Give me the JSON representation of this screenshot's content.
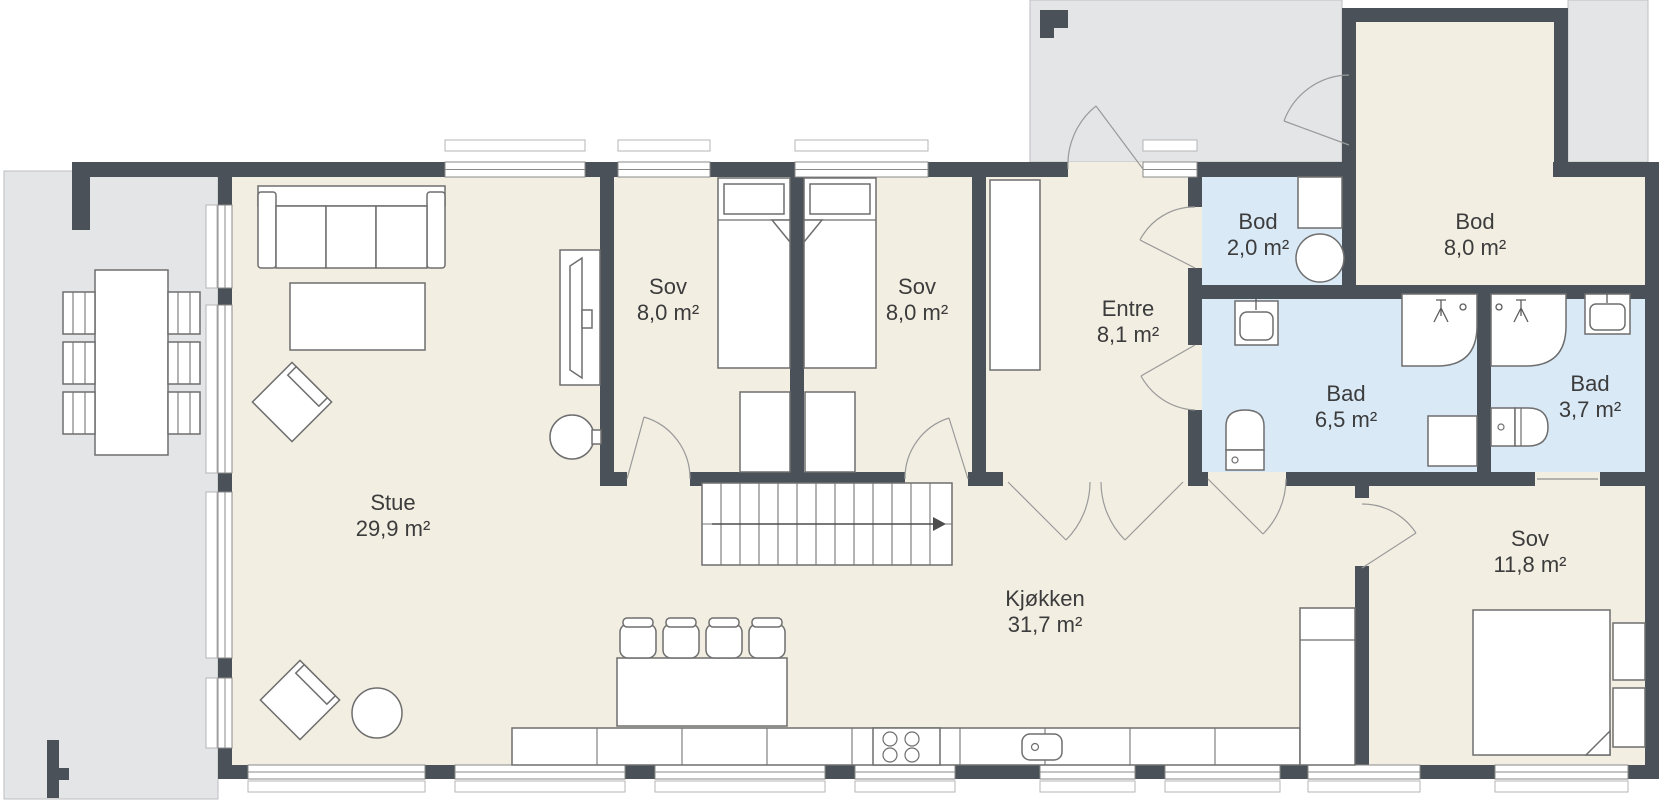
{
  "rooms": {
    "stue": {
      "name": "Stue",
      "area": "29,9 m²"
    },
    "sov1": {
      "name": "Sov",
      "area": "8,0 m²"
    },
    "sov2": {
      "name": "Sov",
      "area": "8,0 m²"
    },
    "entre": {
      "name": "Entre",
      "area": "8,1 m²"
    },
    "bod2": {
      "name": "Bod",
      "area": "2,0 m²"
    },
    "bod8": {
      "name": "Bod",
      "area": "8,0 m²"
    },
    "bad65": {
      "name": "Bad",
      "area": "6,5 m²"
    },
    "bad37": {
      "name": "Bad",
      "area": "3,7 m²"
    },
    "kjokken": {
      "name": "Kjøkken",
      "area": "31,7 m²"
    },
    "sov118": {
      "name": "Sov",
      "area": "11,8 m²"
    }
  },
  "colors": {
    "wall": "#4b5158",
    "floor": "#f2eee2",
    "wet_floor": "#d9e9f6",
    "outdoor": "#e4e5e7",
    "furniture_line": "#6e6e6e"
  }
}
